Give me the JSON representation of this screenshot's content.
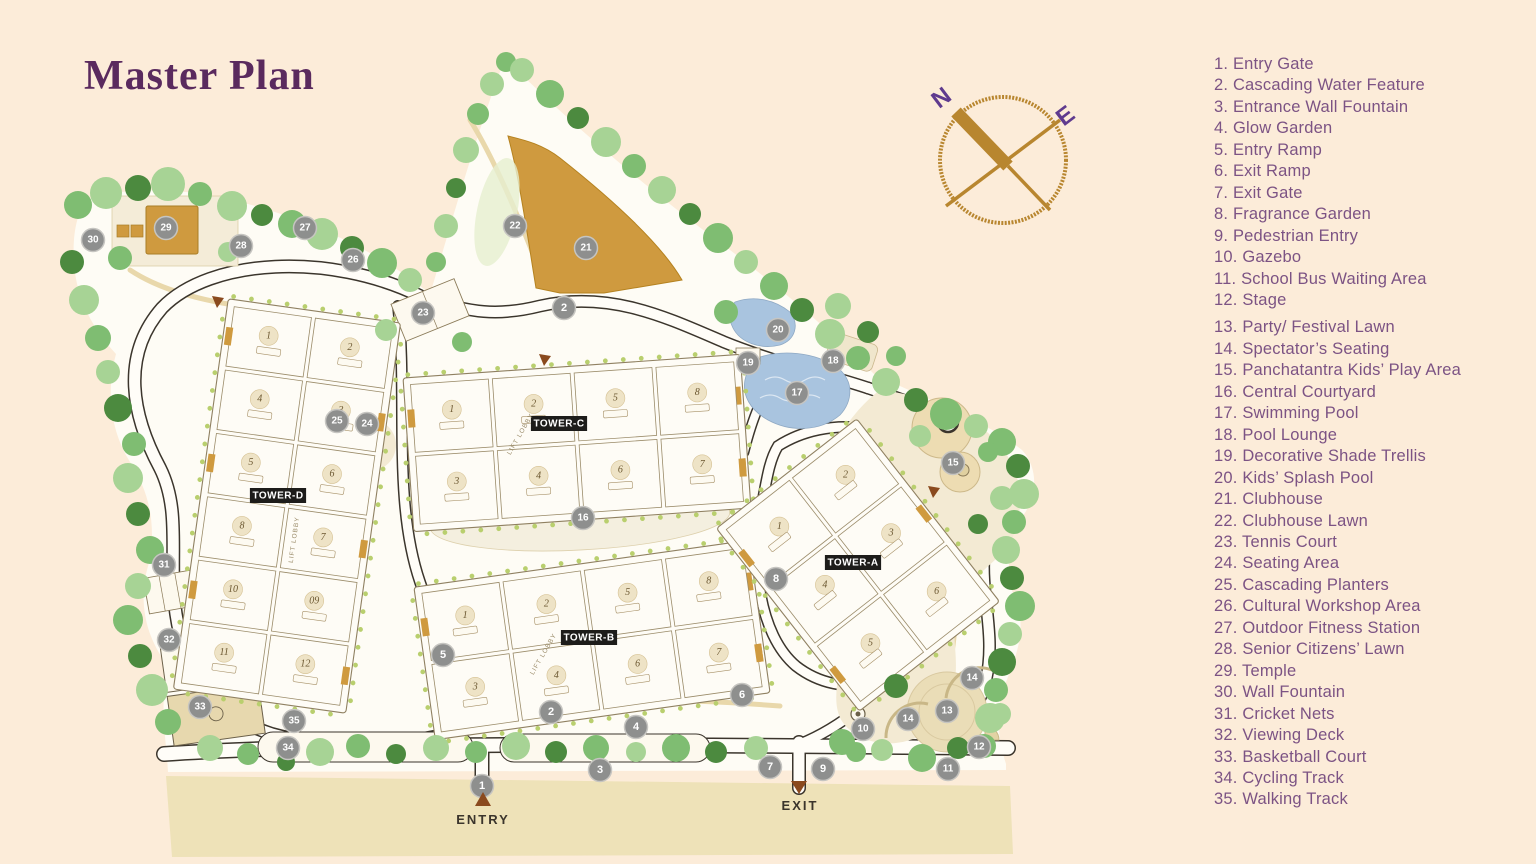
{
  "title": "Master Plan",
  "compass": {
    "north": "N",
    "east": "E"
  },
  "map": {
    "entry_label": "ENTRY",
    "exit_label": "EXIT",
    "lift_lobby_label": "LIFT LOBBY",
    "towers": [
      {
        "id": "tower-d",
        "label": "TOWER-D",
        "units": [
          [
            "1",
            "2"
          ],
          [
            "4",
            "3"
          ],
          [
            "5",
            "6"
          ],
          [
            "8",
            "7"
          ],
          [
            "10",
            "09"
          ],
          [
            "11",
            "12"
          ]
        ]
      },
      {
        "id": "tower-c",
        "label": "TOWER-C",
        "units": [
          [
            "1",
            "2",
            "5",
            "8"
          ],
          [
            "3",
            "4",
            "6",
            "7"
          ]
        ]
      },
      {
        "id": "tower-b",
        "label": "TOWER-B",
        "units": [
          [
            "1",
            "2",
            "5",
            "8"
          ],
          [
            "3",
            "4",
            "6",
            "7"
          ]
        ]
      },
      {
        "id": "tower-a",
        "label": "TOWER-A",
        "units": [
          [
            "1",
            "2"
          ],
          [
            "4",
            "3"
          ],
          [
            "5",
            "6"
          ]
        ]
      }
    ],
    "markers": [
      {
        "n": "1",
        "x": 482,
        "y": 786
      },
      {
        "n": "2",
        "x": 564,
        "y": 308
      },
      {
        "n": "2",
        "x": 551,
        "y": 712
      },
      {
        "n": "3",
        "x": 600,
        "y": 770
      },
      {
        "n": "4",
        "x": 636,
        "y": 727
      },
      {
        "n": "5",
        "x": 443,
        "y": 655
      },
      {
        "n": "6",
        "x": 742,
        "y": 695
      },
      {
        "n": "7",
        "x": 770,
        "y": 767
      },
      {
        "n": "8",
        "x": 776,
        "y": 579
      },
      {
        "n": "9",
        "x": 823,
        "y": 769
      },
      {
        "n": "10",
        "x": 863,
        "y": 729
      },
      {
        "n": "11",
        "x": 948,
        "y": 769
      },
      {
        "n": "12",
        "x": 979,
        "y": 747
      },
      {
        "n": "13",
        "x": 947,
        "y": 711
      },
      {
        "n": "14",
        "x": 972,
        "y": 678
      },
      {
        "n": "14",
        "x": 908,
        "y": 719
      },
      {
        "n": "15",
        "x": 953,
        "y": 463
      },
      {
        "n": "16",
        "x": 583,
        "y": 518
      },
      {
        "n": "17",
        "x": 797,
        "y": 393
      },
      {
        "n": "18",
        "x": 833,
        "y": 361
      },
      {
        "n": "19",
        "x": 748,
        "y": 363
      },
      {
        "n": "20",
        "x": 778,
        "y": 330
      },
      {
        "n": "21",
        "x": 586,
        "y": 248
      },
      {
        "n": "22",
        "x": 515,
        "y": 226
      },
      {
        "n": "23",
        "x": 423,
        "y": 313
      },
      {
        "n": "24",
        "x": 367,
        "y": 424
      },
      {
        "n": "25",
        "x": 337,
        "y": 421
      },
      {
        "n": "26",
        "x": 353,
        "y": 260
      },
      {
        "n": "27",
        "x": 305,
        "y": 228
      },
      {
        "n": "28",
        "x": 241,
        "y": 246
      },
      {
        "n": "29",
        "x": 166,
        "y": 228
      },
      {
        "n": "30",
        "x": 93,
        "y": 240
      },
      {
        "n": "31",
        "x": 164,
        "y": 565
      },
      {
        "n": "32",
        "x": 169,
        "y": 640
      },
      {
        "n": "33",
        "x": 200,
        "y": 707
      },
      {
        "n": "34",
        "x": 288,
        "y": 748
      },
      {
        "n": "35",
        "x": 294,
        "y": 721
      }
    ]
  },
  "legend": {
    "items": [
      "1. Entry Gate",
      "2. Cascading Water Feature",
      "3. Entrance Wall Fountain",
      "4. Glow Garden",
      "5. Entry Ramp",
      "6. Exit Ramp",
      "7. Exit Gate",
      "8. Fragrance Garden",
      "9. Pedestrian Entry",
      "10. Gazebo",
      "11. School Bus Waiting Area",
      "12. Stage",
      "13. Party/ Festival Lawn",
      "14. Spectator’s Seating",
      "15. Panchatantra Kids’ Play Area",
      "16. Central Courtyard",
      "17. Swimming Pool",
      "18. Pool Lounge",
      "19. Decorative Shade Trellis",
      "20. Kids’ Splash Pool",
      "21. Clubhouse",
      "22. Clubhouse Lawn",
      "23. Tennis Court",
      "24. Seating Area",
      "25. Cascading Planters",
      "26. Cultural Workshop Area",
      "27. Outdoor Fitness Station",
      "28. Senior Citizens’ Lawn",
      "29. Temple",
      "30. Wall Fountain",
      "31. Cricket Nets",
      "32. Viewing Deck",
      "33. Basketball Court",
      "34. Cycling Track",
      "35. Walking Track"
    ],
    "gap_after_item": 12
  },
  "colors": {
    "background": "#fcecd9",
    "legend_text": "#7c5384",
    "title_text": "#5a2a5e",
    "compass_brown": "#b8862f",
    "compass_letters": "#5f3a8e",
    "marker_gray": "#8e8f8e",
    "pool_blue": "#a9c4df",
    "clubhouse_gold": "#cf9a3f",
    "tree_light": "#a7d395",
    "tree_mid": "#7fbd72",
    "tree_dark": "#4c8a3f"
  }
}
